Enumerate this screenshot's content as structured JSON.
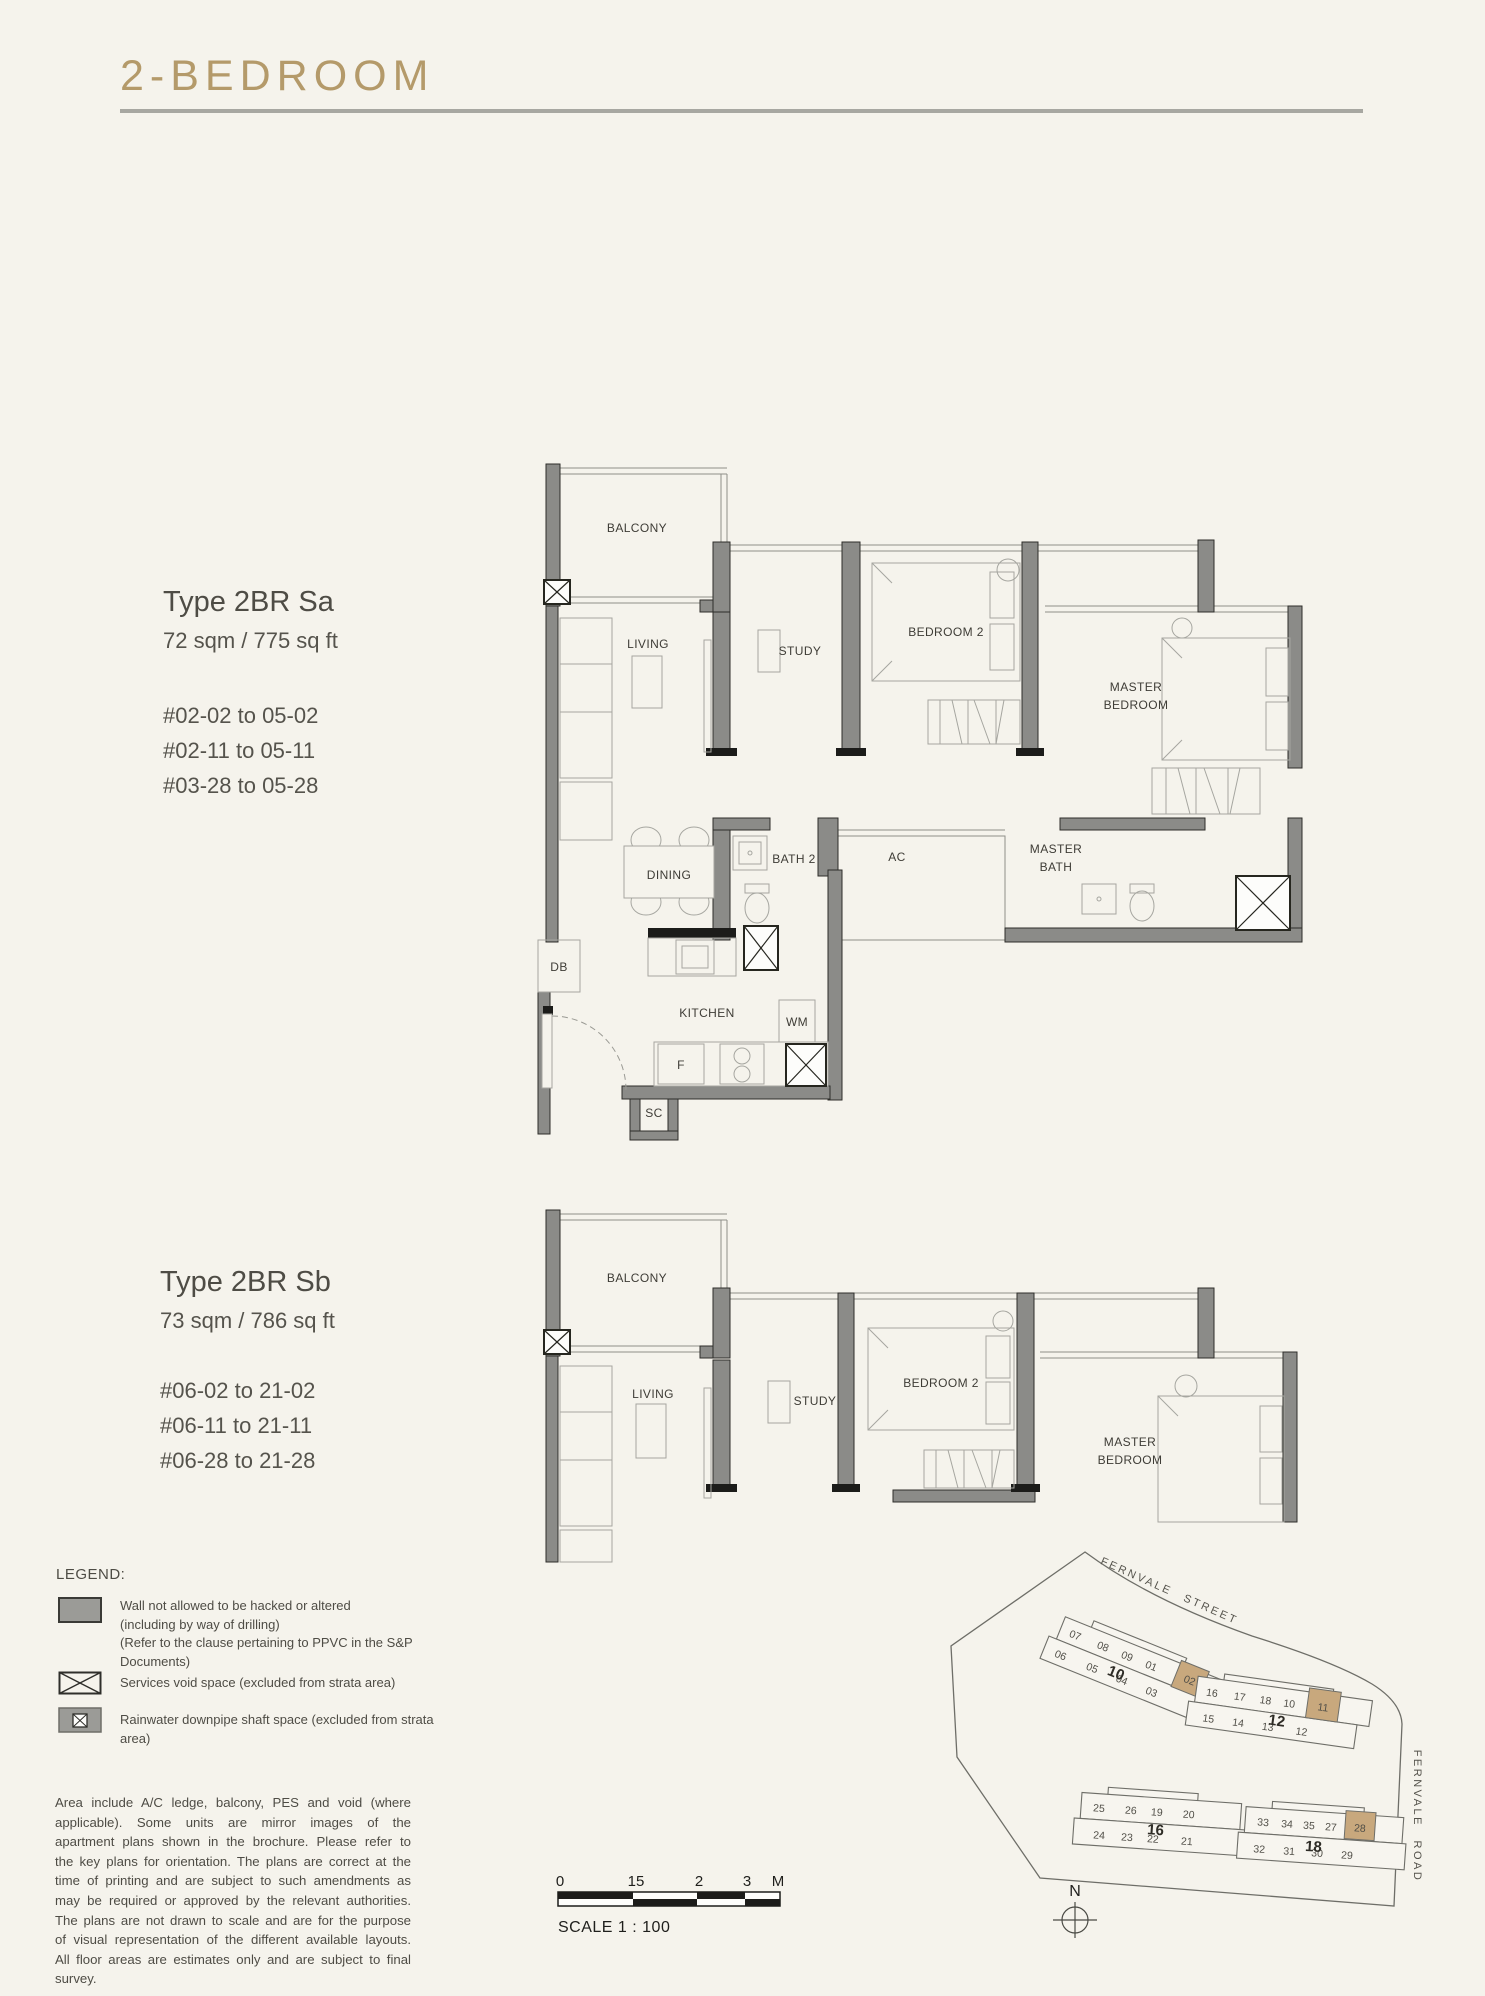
{
  "title": "2-BEDROOM",
  "unit_types": [
    {
      "name": "Type 2BR Sa",
      "area": "72 sqm / 775 sq ft",
      "units": [
        "#02-02 to 05-02",
        "#02-11 to 05-11",
        "#03-28 to 05-28"
      ]
    },
    {
      "name": "Type 2BR Sb",
      "area": "73 sqm / 786 sq ft",
      "units": [
        "#06-02 to 21-02",
        "#06-11 to 21-11",
        "#06-28 to 21-28"
      ]
    }
  ],
  "plan_sa": {
    "balcony": "BALCONY",
    "living": "LIVING",
    "study": "STUDY",
    "bedroom2": "BEDROOM 2",
    "master_l1": "MASTER",
    "master_l2": "BEDROOM",
    "dining": "DINING",
    "bath2": "BATH 2",
    "ac": "AC",
    "master_bath_l1": "MASTER",
    "master_bath_l2": "BATH",
    "kitchen": "KITCHEN",
    "wm": "WM",
    "fridge": "F",
    "db": "DB",
    "sc": "SC"
  },
  "plan_sb": {
    "balcony": "BALCONY",
    "living": "LIVING",
    "study": "STUDY",
    "bedroom2": "BEDROOM 2",
    "master_l1": "MASTER",
    "master_l2": "BEDROOM"
  },
  "legend": {
    "heading": "LEGEND:",
    "wall_l1": "Wall not allowed to be hacked or altered",
    "wall_l2": "(including by way of drilling)",
    "wall_l3": "(Refer to the clause pertaining to PPVC in the S&P Documents)",
    "services_void": "Services void space (excluded from strata area)",
    "rainwater": "Rainwater downpipe shaft space (excluded from strata area)"
  },
  "disclaimer": "Area include A/C ledge, balcony, PES and void (where applicable). Some units are mirror images of the apartment plans shown in the brochure. Please refer to the key plans for orientation. The plans are correct at the time of printing and are subject to such amendments as may be required or approved by the relevant authorities. The plans are not drawn to scale and are for the purpose of visual representation of the different available layouts. All floor areas are estimates only and are subject to final survey.",
  "scalebar": {
    "t0": "0",
    "t1": "15",
    "t2": "2",
    "t3": "3",
    "unit": "M",
    "label": "SCALE 1 : 100"
  },
  "siteplan": {
    "street": "FERNVALE STREET",
    "road": "FERNVALE ROAD",
    "north": "N",
    "highlighted_units": [
      "02",
      "11",
      "28"
    ],
    "blocks": [
      {
        "number": "10",
        "row1": [
          "07",
          "08",
          "09",
          "01",
          "02"
        ],
        "row2": [
          "06",
          "05",
          "04",
          "03"
        ],
        "highlighted": "02"
      },
      {
        "number": "12",
        "row1": [
          "16",
          "17",
          "18",
          "10",
          "11"
        ],
        "row2": [
          "15",
          "14",
          "13",
          "12"
        ],
        "highlighted": "11"
      },
      {
        "number": "16",
        "row1": [
          "25",
          "26",
          "19",
          "20"
        ],
        "row2": [
          "24",
          "23",
          "22",
          "21"
        ],
        "highlighted": null
      },
      {
        "number": "18",
        "row1": [
          "33",
          "34",
          "35",
          "27",
          "28"
        ],
        "row2": [
          "32",
          "31",
          "30",
          "29"
        ],
        "highlighted": "28"
      }
    ]
  },
  "colors": {
    "accent_gold": "#B49A6A",
    "highlight_tan": "#C8A87D",
    "wall_gray": "#8B8B88",
    "cream_bg": "#F5F3EC"
  }
}
